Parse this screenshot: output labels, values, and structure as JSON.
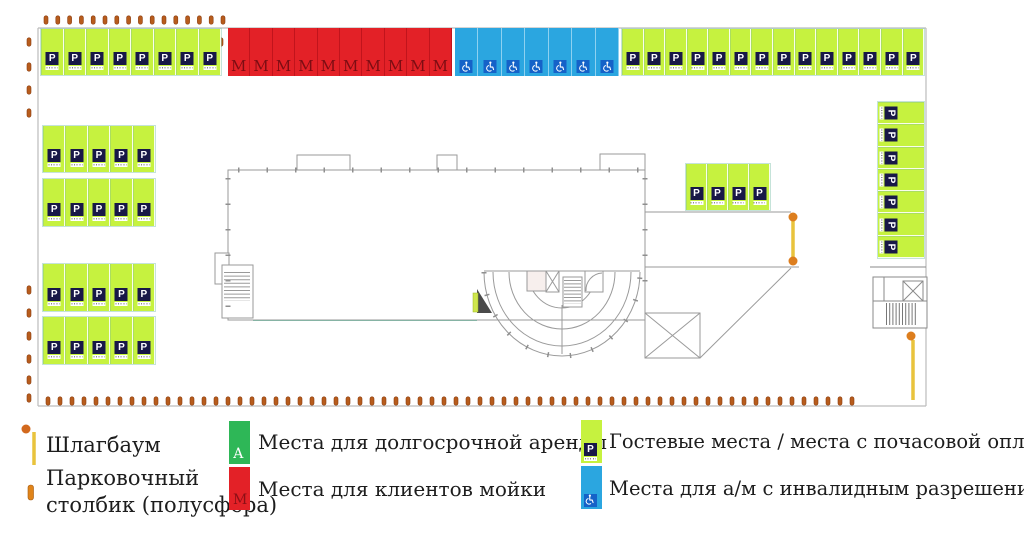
{
  "map": {
    "name": "Схема парковки",
    "icons": {
      "p_letter": "P",
      "wash_letter": "М"
    }
  },
  "parking": {
    "groups": [
      {
        "name": "top-left",
        "type": "guest",
        "count": 8
      },
      {
        "name": "top-wash",
        "type": "wash",
        "count": 10
      },
      {
        "name": "top-disabled",
        "type": "disabled",
        "count": 7
      },
      {
        "name": "top-right",
        "type": "guest",
        "count": 14
      },
      {
        "name": "left-a1",
        "type": "guest",
        "count": 5
      },
      {
        "name": "left-a2",
        "type": "guest",
        "count": 5
      },
      {
        "name": "left-b1",
        "type": "guest",
        "count": 5
      },
      {
        "name": "left-b2",
        "type": "guest",
        "count": 5
      },
      {
        "name": "mid",
        "type": "guest",
        "count": 4
      },
      {
        "name": "right-col",
        "type": "guest",
        "count": 7,
        "orientation": "horizontal"
      }
    ]
  },
  "legend": {
    "barrier_label": "Шлагбаум",
    "bollard_label_line1": "Парковочный",
    "bollard_label_line2": "столбик (полусфера)",
    "items": [
      {
        "key": "rental",
        "letter": "А",
        "color": "#2eb757",
        "label": "Места для долгосрочной аренды"
      },
      {
        "key": "wash",
        "letter": "М",
        "color": "#e32127",
        "label": "Места для клиентов мойки"
      },
      {
        "key": "guest",
        "color": "#c6f23f",
        "label": "Гостевые места / места с почасовой оплатой"
      },
      {
        "key": "disabled",
        "color": "#2ba6e0",
        "label": "Места для а/м с инвалидным разрешением"
      }
    ]
  }
}
